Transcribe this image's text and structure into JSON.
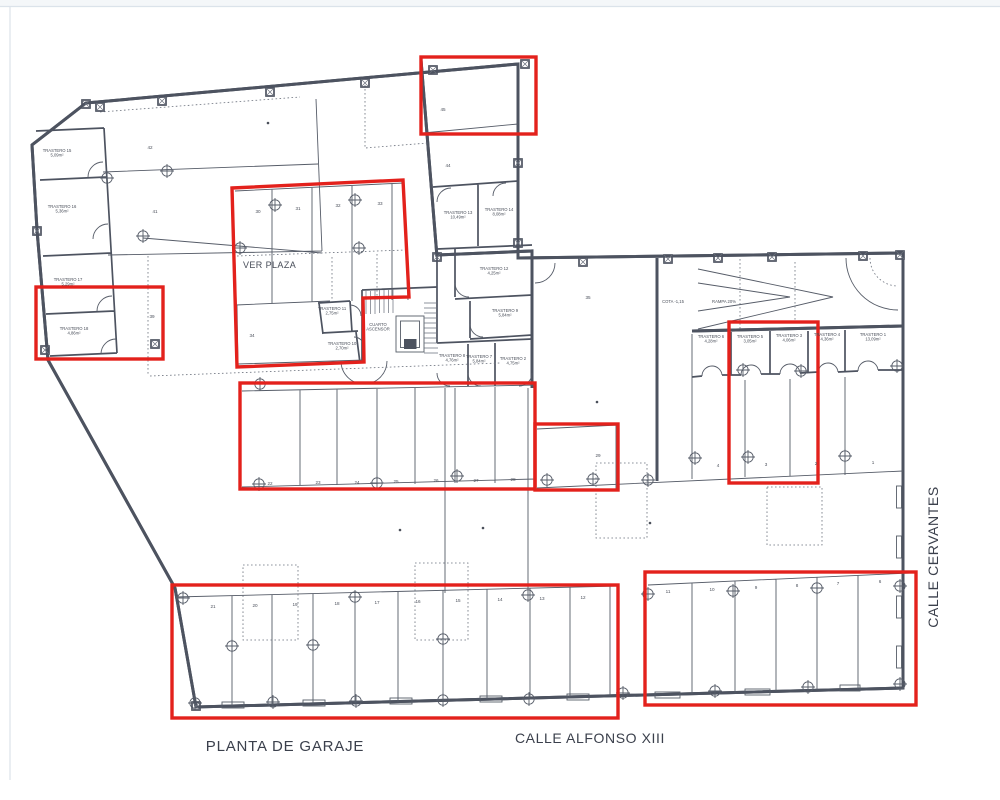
{
  "plan": {
    "title": "PLANTA DE GARAJE",
    "street_bottom": "CALLE ALFONSO XIII",
    "street_right": "CALLE CERVANTES",
    "ver_plaza_label": "VER PLAZA",
    "cota_label": "COTA -1,15",
    "rampa_label": "RAMPA 20%",
    "machine_room_line1": "CUARTO",
    "machine_room_line2": "ASCENSOR",
    "colors": {
      "line": "#4d5360",
      "highlight": "#e3211c"
    },
    "storerooms": [
      {
        "name": "TRASTERO 15",
        "area": "5,09m²",
        "x": 57,
        "y": 152
      },
      {
        "name": "TRASTERO 16",
        "area": "5,36m²",
        "x": 62,
        "y": 208
      },
      {
        "name": "TRASTERO 17",
        "area": "5,29m²",
        "x": 68,
        "y": 281
      },
      {
        "name": "TRASTERO 18",
        "area": "4,86m²",
        "x": 74,
        "y": 330
      },
      {
        "name": "TRASTERO 13",
        "area": "10,49m²",
        "x": 458,
        "y": 214
      },
      {
        "name": "TRASTERO 14",
        "area": "8,08m²",
        "x": 499,
        "y": 211
      },
      {
        "name": "TRASTERO 12",
        "area": "4,25m²",
        "x": 494,
        "y": 270
      },
      {
        "name": "TRASTERO 9",
        "area": "5,84m²",
        "x": 505,
        "y": 312
      },
      {
        "name": "TRASTERO 11",
        "area": "2,75m²",
        "x": 332,
        "y": 310
      },
      {
        "name": "TRASTERO 10",
        "area": "2,70m²",
        "x": 342,
        "y": 345
      },
      {
        "name": "TRASTERO 8",
        "area": "4,76m²",
        "x": 452,
        "y": 357
      },
      {
        "name": "TRASTERO 7",
        "area": "5,84m²",
        "x": 479,
        "y": 358
      },
      {
        "name": "TRASTERO 2",
        "area": "4,75m²",
        "x": 513,
        "y": 360
      },
      {
        "name": "TRASTERO 6",
        "area": "4,28m²",
        "x": 711,
        "y": 338
      },
      {
        "name": "TRASTERO 5",
        "area": "3,05m²",
        "x": 750,
        "y": 338
      },
      {
        "name": "TRASTERO 3",
        "area": "4,06m²",
        "x": 789,
        "y": 337
      },
      {
        "name": "TRASTERO 4",
        "area": "4,36m²",
        "x": 827,
        "y": 336
      },
      {
        "name": "TRASTERO 1",
        "area": "13,09m²",
        "x": 873,
        "y": 336
      }
    ],
    "parking_numbers": [
      {
        "n": "45",
        "x": 443,
        "y": 111
      },
      {
        "n": "44",
        "x": 448,
        "y": 167
      },
      {
        "n": "42",
        "x": 150,
        "y": 149
      },
      {
        "n": "41",
        "x": 155,
        "y": 213
      },
      {
        "n": "39",
        "x": 152,
        "y": 318
      },
      {
        "n": "30",
        "x": 258,
        "y": 213
      },
      {
        "n": "31",
        "x": 298,
        "y": 210
      },
      {
        "n": "32",
        "x": 338,
        "y": 207
      },
      {
        "n": "33",
        "x": 380,
        "y": 205
      },
      {
        "n": "34",
        "x": 252,
        "y": 337
      },
      {
        "n": "35",
        "x": 588,
        "y": 299
      },
      {
        "n": "22",
        "x": 270,
        "y": 485
      },
      {
        "n": "23",
        "x": 318,
        "y": 484
      },
      {
        "n": "24",
        "x": 357,
        "y": 484
      },
      {
        "n": "25",
        "x": 396,
        "y": 483
      },
      {
        "n": "26",
        "x": 436,
        "y": 482
      },
      {
        "n": "27",
        "x": 476,
        "y": 482
      },
      {
        "n": "28",
        "x": 513,
        "y": 481
      },
      {
        "n": "29",
        "x": 598,
        "y": 457
      },
      {
        "n": "4",
        "x": 718,
        "y": 467
      },
      {
        "n": "3",
        "x": 766,
        "y": 466
      },
      {
        "n": "2",
        "x": 816,
        "y": 465
      },
      {
        "n": "1",
        "x": 873,
        "y": 464
      },
      {
        "n": "21",
        "x": 213,
        "y": 608
      },
      {
        "n": "20",
        "x": 255,
        "y": 607
      },
      {
        "n": "19",
        "x": 295,
        "y": 606
      },
      {
        "n": "18",
        "x": 337,
        "y": 605
      },
      {
        "n": "17",
        "x": 377,
        "y": 604
      },
      {
        "n": "16",
        "x": 418,
        "y": 603
      },
      {
        "n": "15",
        "x": 458,
        "y": 602
      },
      {
        "n": "14",
        "x": 500,
        "y": 601
      },
      {
        "n": "13",
        "x": 542,
        "y": 600
      },
      {
        "n": "12",
        "x": 583,
        "y": 599
      },
      {
        "n": "11",
        "x": 668,
        "y": 593
      },
      {
        "n": "10",
        "x": 712,
        "y": 591
      },
      {
        "n": "9",
        "x": 756,
        "y": 589
      },
      {
        "n": "8",
        "x": 797,
        "y": 587
      },
      {
        "n": "7",
        "x": 838,
        "y": 585
      },
      {
        "n": "6",
        "x": 880,
        "y": 583
      }
    ]
  }
}
